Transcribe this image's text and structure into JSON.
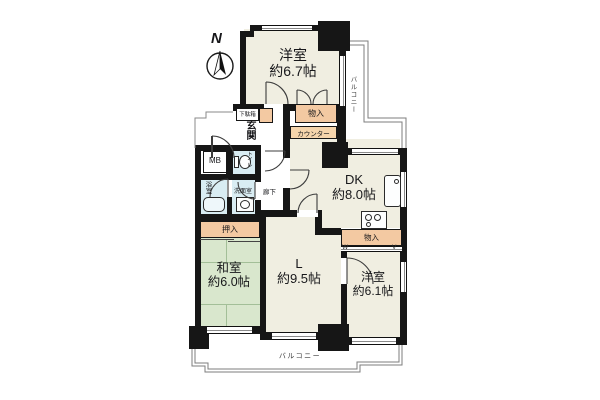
{
  "plan": {
    "compass_north": "N",
    "rooms": {
      "western_top": {
        "name": "洋室",
        "size": "約6.7帖"
      },
      "dk": {
        "name": "DK",
        "size": "約8.0帖"
      },
      "living": {
        "name": "L",
        "size": "約9.5帖"
      },
      "japanese": {
        "name": "和室",
        "size": "約6.0帖"
      },
      "western_br": {
        "name": "洋室",
        "size": "約6.1帖"
      },
      "entrance": "玄関",
      "hallway": "廊下",
      "bathroom": "浴室",
      "washroom": "洗面室",
      "toilet": "トイレ",
      "meter_box": "MB"
    },
    "storage": {
      "shoe_box": "下駄箱",
      "closet_top": "物入",
      "counter": "カウンター",
      "oshiire": "押入",
      "closet_right": "物入"
    },
    "balconies": {
      "right": "バルコニー",
      "bottom": "バルコニー"
    },
    "door_marks": {
      "left": "W",
      "right": "V"
    },
    "colors": {
      "wall": "#161616",
      "room_floor": "#f0eee1",
      "tatami": "#d9e7cd",
      "storage": "#f3c9a2",
      "wet_area": "#d9edf3",
      "background": "#ffffff"
    }
  }
}
